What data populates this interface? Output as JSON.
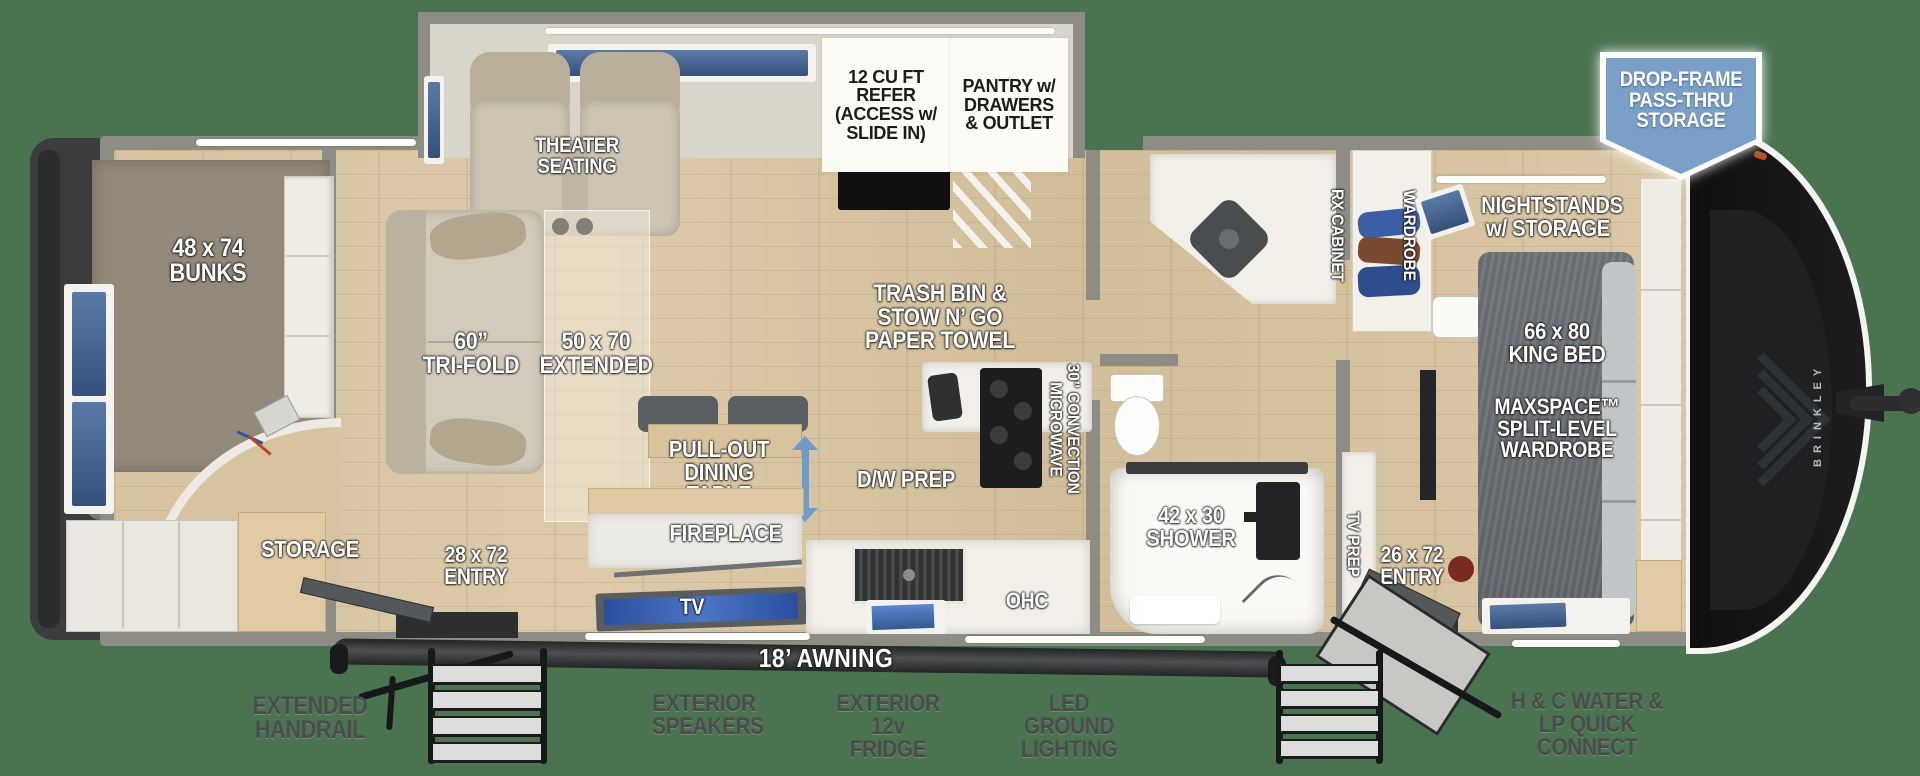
{
  "colors": {
    "background_green": "#4a7350",
    "badge_blue": "#7aa0ca",
    "window_blue": "#3f5f8c",
    "arrow_blue": "#6f9bc8",
    "wall_gray": "#8d8d86",
    "front_cap_black": "#141414",
    "label_dark_gray": "#4b4c4e"
  },
  "badge": {
    "text": "DROP-FRAME\nPASS-THRU\nSTORAGE"
  },
  "exterior": {
    "rear_compartment": "REAR STORAGE COMPARTMENT",
    "brand": "BRINKLEY",
    "awning": "18’ AWNING",
    "handrail": "EXTENDED\nHANDRAIL",
    "speakers": "EXTERIOR\nSPEAKERS",
    "fridge": "EXTERIOR\n12v FRIDGE",
    "lighting": "LED GROUND\nLIGHTING",
    "water": "H & C WATER &\nLP QUICK CONNECT"
  },
  "slide_out": {
    "theater": "THEATER SEATING",
    "refer": "12 CU FT\nREFER\n(ACCESS w/\nSLIDE IN)",
    "pantry": "PANTRY w/\nDRAWERS\n& OUTLET"
  },
  "bunk_room": {
    "bunks": "48 x 74\nBUNKS",
    "storage": "STORAGE"
  },
  "living": {
    "trifold": "60”\nTRI-FOLD",
    "extended": "50 x 70\nEXTENDED",
    "dining": "PULL-OUT\nDINING TABLE\nw/ DRAWER",
    "fireplace": "FIREPLACE",
    "tv": "TV",
    "entry": "28 x 72\nENTRY"
  },
  "kitchen": {
    "trash": "TRASH BIN &\nSTOW N’ GO\nPAPER TOWEL",
    "microwave": "30” CONVECTION\nMICROWAVE",
    "dw_prep": "D/W PREP",
    "ohc": "OHC"
  },
  "bathroom": {
    "shower": "42 x 30\nSHOWER"
  },
  "bedroom": {
    "rx_cabinet": "RX CABINET",
    "wardrobe": "WARDROBE",
    "nightstands": "NIGHTSTANDS\nw/ STORAGE",
    "king_bed": "66 x 80\nKING BED",
    "maxspace": "MAXSPACE™\nSPLIT-LEVEL\nWARDROBE",
    "tv_prep": "TV PREP",
    "entry": "26 x 72\nENTRY"
  }
}
